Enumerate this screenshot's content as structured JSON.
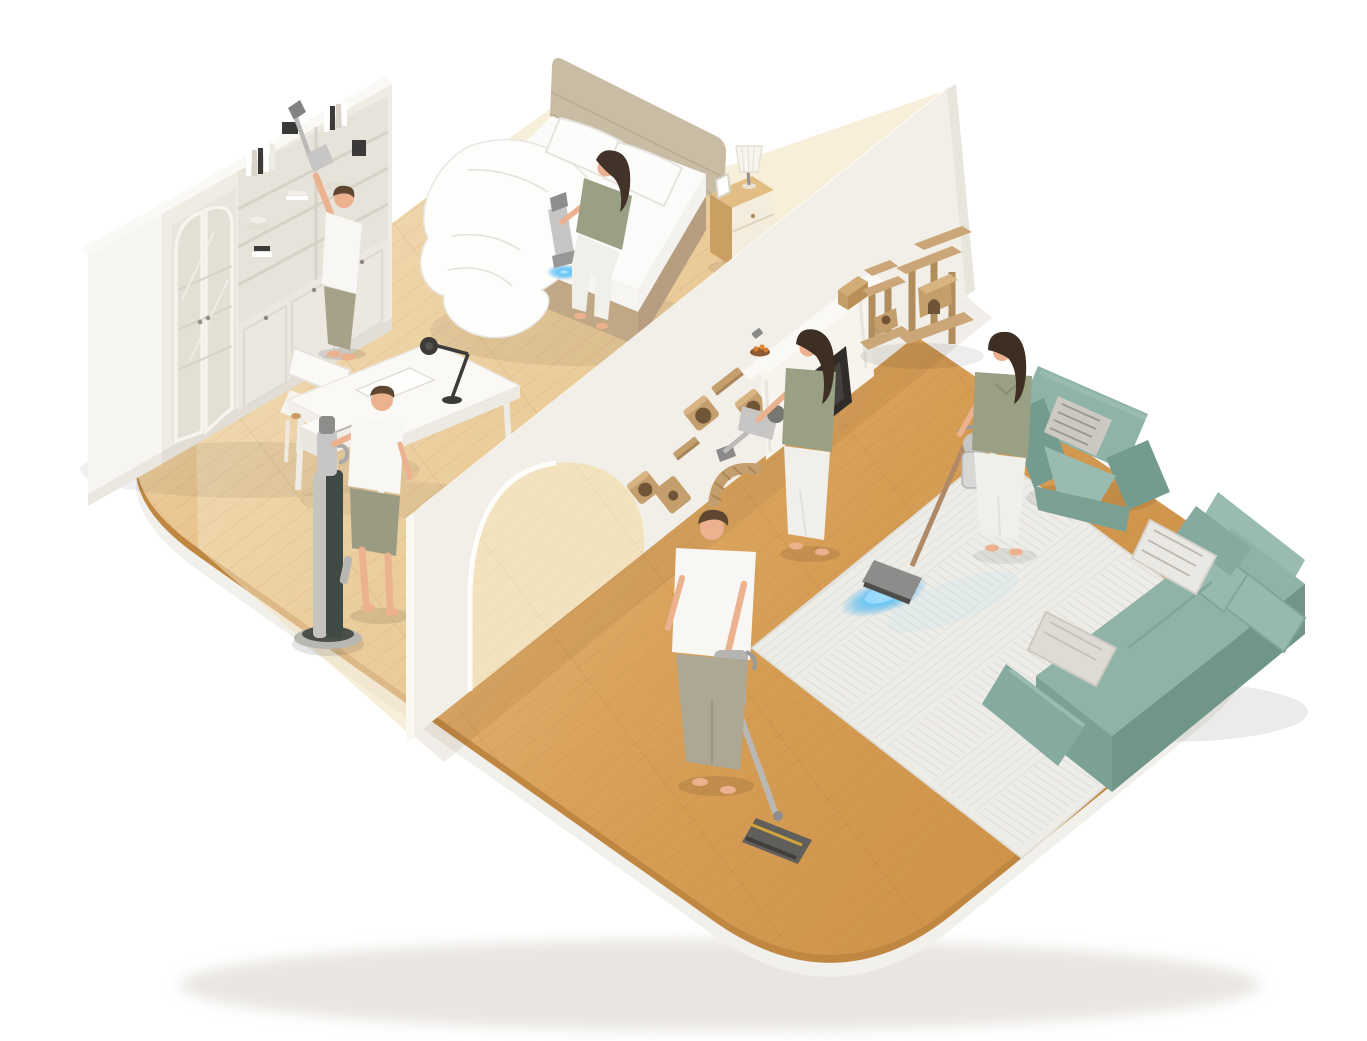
{
  "image_kind": "3d-isometric-home-cleaning-illustration",
  "visible_text": [],
  "palette": {
    "bg": "#FFFFFF",
    "wood-main": "#D69D55",
    "wood-deep": "#CE9148",
    "wood-pale": "#F3E2BE",
    "wood-side": "#C08743",
    "rim": "#F2F0EA",
    "wall": "#F2EFE8",
    "wall-bright": "#FCFAF6",
    "wall-shade": "#E8E5DD",
    "cream": "#EFECE4",
    "teal": "#8FB3A7",
    "teal-dark": "#739B8E",
    "teal-light": "#9ABCB0",
    "rug": "#EDECE7",
    "tan": "#C49E6C",
    "tan-dark": "#A9855A",
    "tan-hole": "#6F5436",
    "beige-headboard": "#C9BCA4",
    "bed-base": "#B79E80",
    "linen": "#FBFBF9",
    "skin": "#ECB18E",
    "hair-dark": "#42332A",
    "hair-brown": "#5E4630",
    "shirt-white": "#F8F7F4",
    "shirt-olive": "#99A083",
    "pants-khaki": "#A8A18A",
    "pants-white": "#F0EFEA",
    "metal": "#C7C6C4",
    "metal-dark": "#8E8D8B",
    "dock-dark": "#404A44",
    "copper": "#B08A66",
    "glow-blue": "#3FB9F6"
  },
  "scene": {
    "description": "Isometric cutaway of a home on a rounded wooden platform; six people clean with cordless vacuums; blue dust-illumination light glows on the mattress and rug.",
    "people_count": 6,
    "vacuum_count": 6,
    "items": [
      {
        "id": "floor-platform",
        "label": "Rounded wooden floor platform with white base rim"
      },
      {
        "id": "partition-wall",
        "label": "White partition wall with arched doorway"
      },
      {
        "id": "bookshelf",
        "label": "Cream bookshelf wall unit with arched glass doors"
      },
      {
        "id": "bed",
        "label": "Double bed with white bedding and beige headboard"
      },
      {
        "id": "nightstand",
        "label": "Wooden nightstand with pleated table lamp and photo frame"
      },
      {
        "id": "desk",
        "label": "White writing desk with chair, laptop and black desk lamp"
      },
      {
        "id": "charging-dock",
        "label": "Tall cordless-vacuum charging dock"
      },
      {
        "id": "cat-shelves",
        "label": "Wall-mounted cat climbing boxes, shelves and bridge"
      },
      {
        "id": "fireplace-console",
        "label": "White fireplace media console with box and fruit bowl"
      },
      {
        "id": "cat-trees",
        "label": "Beige cat tree towers"
      },
      {
        "id": "rug",
        "label": "White herringbone area rug"
      },
      {
        "id": "armchair",
        "label": "Sage-green armchair with striped cushion"
      },
      {
        "id": "sofa",
        "label": "Sage-green sofa with cushions and striped pillows"
      }
    ],
    "people": [
      {
        "id": "bookshelf-man",
        "label": "Man dusting bookshelf top with handheld vacuum"
      },
      {
        "id": "bed-woman",
        "label": "Woman vacuuming mattress with handheld vacuum, blue light on bedding"
      },
      {
        "id": "dock-man",
        "label": "Man standing at vacuum charging dock"
      },
      {
        "id": "wall-woman",
        "label": "Woman vacuuming cat wall shelves with handheld vacuum"
      },
      {
        "id": "rug-woman",
        "label": "Woman vacuuming rug with stick vacuum, blue light on rug"
      },
      {
        "id": "floor-man",
        "label": "Man vacuuming wooden floor with stick vacuum"
      }
    ]
  }
}
